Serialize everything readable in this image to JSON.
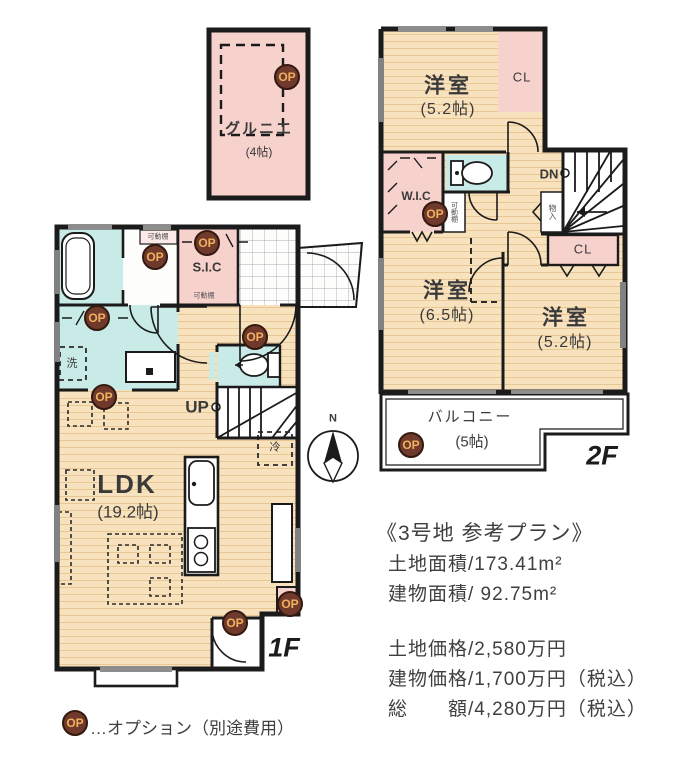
{
  "colors": {
    "wall": "#1b1b1b",
    "wood_floor": "#f8e2bd",
    "wood_line": "#e7c794",
    "closet_pink": "#f7d2cd",
    "wet_cyan": "#c9ebe8",
    "op_bg": "#6f3a2c",
    "op_text": "#f2b05e"
  },
  "attic": {
    "name": "グルニエ",
    "size": "(4帖)"
  },
  "floor2": {
    "label": "2F",
    "bedroom_top": {
      "name": "洋室",
      "size": "(5.2帖)"
    },
    "bedroom_left": {
      "name": "洋室",
      "size": "(6.5帖)"
    },
    "bedroom_right": {
      "name": "洋室",
      "size": "(5.2帖)"
    },
    "closet_top": "CL",
    "closet_mid": "CL",
    "wic": "W.I.C",
    "down": "DN",
    "storage": "物入",
    "shelf": "可動棚",
    "balcony": {
      "name": "バルコニー",
      "size": "(5帖)"
    }
  },
  "floor1": {
    "label": "1F",
    "ldk": {
      "name": "LDK",
      "size": "(19.2帖)"
    },
    "shoe_closet": "S.I.C",
    "up": "UP",
    "washer": "洗",
    "fridge": "冷",
    "shelf_hall": "可動棚",
    "shelf_sic": "可動棚"
  },
  "compass": {
    "north": "N"
  },
  "info": {
    "title": "《3号地 参考プラン》",
    "land_area": "土地面積/173.41m²",
    "building_area": "建物面積/ 92.75m²",
    "land_price": "土地価格/2,580万円",
    "building_price": "建物価格/1,700万円（税込）",
    "total_price": "総　　額/4,280万円（税込）"
  },
  "legend": {
    "badge": "OP",
    "text": "…オプション（別途費用）"
  },
  "op_badge_label": "OP"
}
